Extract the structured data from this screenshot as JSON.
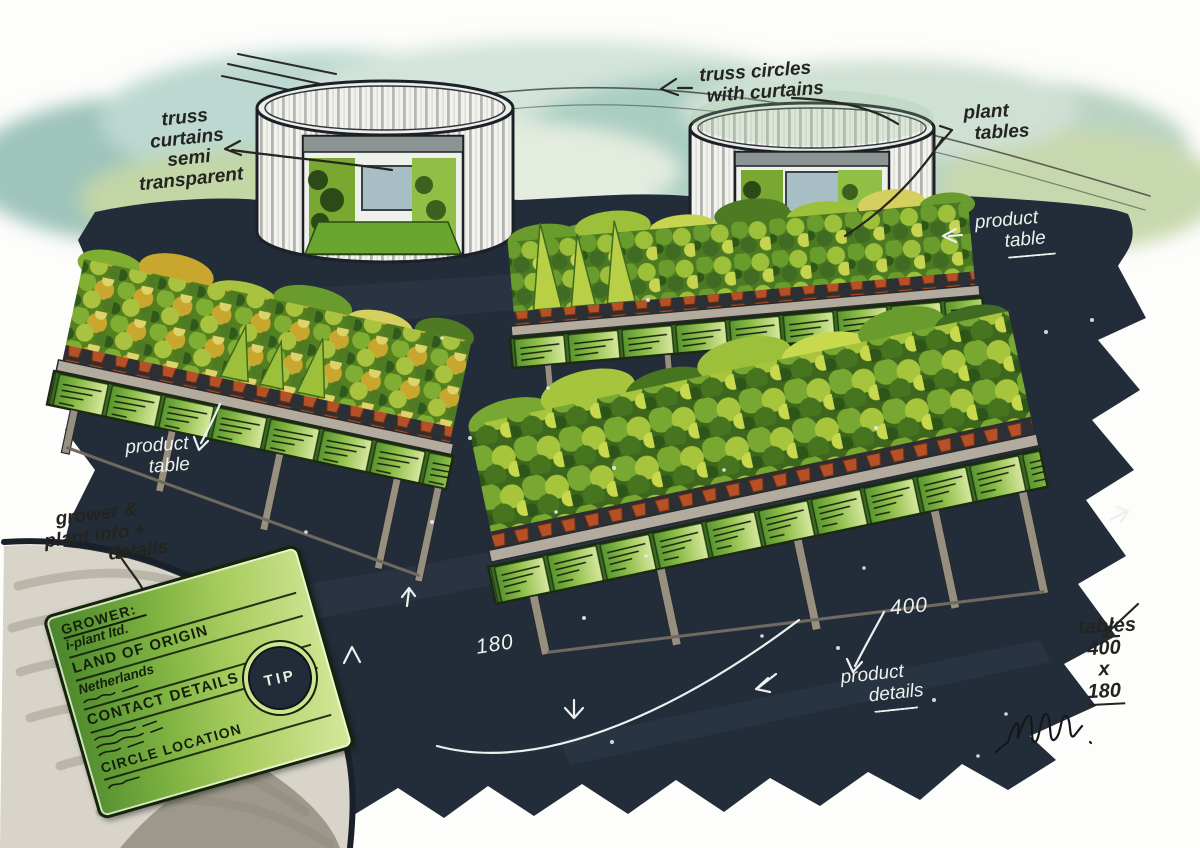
{
  "annotations": {
    "truss_curtains": {
      "lines": [
        "truss",
        "curtains",
        "semi",
        "transparent"
      ]
    },
    "truss_circles": {
      "lines": [
        "truss circles",
        "with curtains"
      ]
    },
    "plant_tables": {
      "lines": [
        "plant",
        "tables"
      ]
    },
    "product_table_right": {
      "lines": [
        "product",
        "table"
      ]
    },
    "product_table_left": {
      "lines": [
        "product",
        "table"
      ]
    },
    "product_details": {
      "lines": [
        "product",
        "details"
      ]
    },
    "grower_info": {
      "lines": [
        "grower &",
        "plant info +",
        "details"
      ]
    },
    "dim_width": "180",
    "dim_length": "400",
    "table_size": {
      "lines": [
        "tables",
        "400",
        "x",
        "180"
      ]
    }
  },
  "inset": {
    "grower_label": "GROWER:",
    "grower_value": "i-plant ltd.",
    "origin_label": "LAND OF ORIGIN",
    "origin_value": "Netherlands",
    "contact_label": "CONTACT DETAILS",
    "location_label": "CIRCLE LOCATION",
    "tip_label": "TIP"
  },
  "colors": {
    "floor_dark": "#232d39",
    "sky_teal": "#aecfc8",
    "card_green": "#7fb342",
    "pot_terracotta": "#b65127",
    "annotation_black": "#23231f",
    "annotation_white": "#edf1ee"
  }
}
